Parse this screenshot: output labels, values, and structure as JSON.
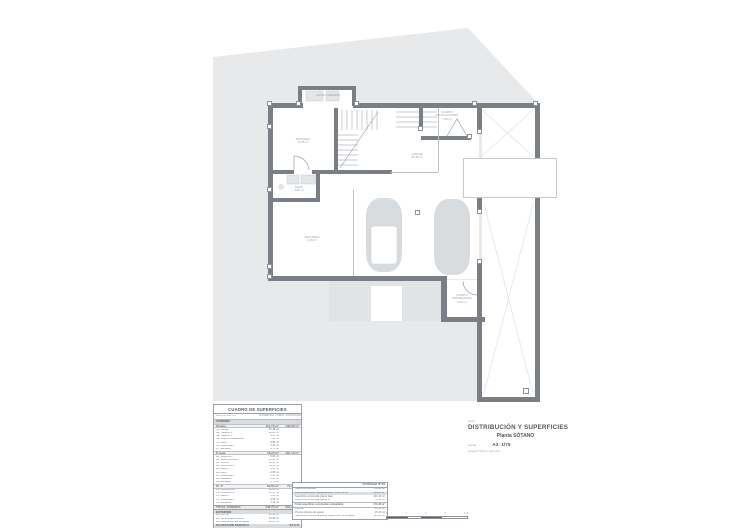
{
  "colors": {
    "site_plot": "#e7e9ea",
    "wall": "#7a7f85",
    "car": "#d9dcdf",
    "title_text": "#54585d"
  },
  "plan": {
    "rooms": {
      "grupo_presion": "GRUPO PRESIÓN",
      "trastero1": "TRASTERO\n12.05 m²",
      "bano": "BAÑO\n3.80 m²",
      "trastero2": "TRASTERO\n9.15 m²",
      "garaje": "GARAJE\n55.48 m²",
      "instalaciones": "CUARTO\nINSTALACIONES\n7.08 m²",
      "depuradora": "CUARTO\nDEPURADORA\n5.20 m²"
    }
  },
  "surfaces_table": {
    "title": "CUADRO DE SUPERFICIES",
    "headers": {
      "name": "DENOMINACIÓN",
      "util": "SUPERFICIE ÚTIL",
      "built": "SUP. CONSTRUIDA"
    },
    "rows": [
      {
        "t": "section",
        "label": "VIVIENDA",
        "util": "",
        "built": ""
      },
      {
        "t": "sub",
        "label": "Sótano",
        "util": "114.75 m²",
        "built": "130.80 m²"
      },
      {
        "t": "item",
        "label": "S1. Garaje",
        "util": "55.48 m²",
        "built": ""
      },
      {
        "t": "item",
        "label": "S2. Trastero 1",
        "util": "12.05 m²",
        "built": ""
      },
      {
        "t": "item",
        "label": "S3. Trastero 2",
        "util": "9.15 m²",
        "built": ""
      },
      {
        "t": "item",
        "label": "S4. Cuarto instalaciones",
        "util": "7.08 m²",
        "built": ""
      },
      {
        "t": "item",
        "label": "S5. Baño",
        "util": "3.80 m²",
        "built": ""
      },
      {
        "t": "item",
        "label": "S6. Distribuidor",
        "util": "4.10 m²",
        "built": ""
      },
      {
        "t": "item",
        "label": "S7. Escalera",
        "util": "4.72 m²",
        "built": ""
      },
      {
        "t": "sub",
        "label": "P. baja",
        "util": "78.20 m²",
        "built": "101.10 m²"
      },
      {
        "t": "item",
        "label": "B1. Vestíbulo",
        "util": "5.30 m²",
        "built": ""
      },
      {
        "t": "item",
        "label": "B2. Salón-comedor",
        "util": "24.60 m²",
        "built": ""
      },
      {
        "t": "item",
        "label": "B3. Cocina",
        "util": "10.15 m²",
        "built": ""
      },
      {
        "t": "item",
        "label": "B4. Dormitorio 1",
        "util": "11.20 m²",
        "built": ""
      },
      {
        "t": "item",
        "label": "B5. Baño 1",
        "util": "4.05 m²",
        "built": ""
      },
      {
        "t": "item",
        "label": "B6. Aseo",
        "util": "2.45 m²",
        "built": ""
      },
      {
        "t": "item",
        "label": "B7. Distribuidor",
        "util": "3.95 m²",
        "built": ""
      },
      {
        "t": "item",
        "label": "B8. Lavadero",
        "util": "3.60 m²",
        "built": ""
      },
      {
        "t": "item",
        "label": "B9. Escalera",
        "util": "4.72 m²",
        "built": ""
      },
      {
        "t": "sub",
        "label": "Pl. 1ª",
        "util": "55.80 m²",
        "built": "72.36 m²"
      },
      {
        "t": "item",
        "label": "P1. Dormitorio 2",
        "util": "14.20 m²",
        "built": ""
      },
      {
        "t": "item",
        "label": "P2. Dormitorio 3",
        "util": "12.35 m²",
        "built": ""
      },
      {
        "t": "item",
        "label": "P3. Baño 2",
        "util": "4.60 m²",
        "built": ""
      },
      {
        "t": "item",
        "label": "P4. Distribuidor",
        "util": "4.25 m²",
        "built": ""
      },
      {
        "t": "item",
        "label": "P5. Escalera",
        "util": "4.72 m²",
        "built": ""
      },
      {
        "t": "total",
        "label": "TOTAL VIVIENDA",
        "util": "248.75 m²",
        "built": "304.26 m²"
      },
      {
        "t": "section",
        "label": "EXTERIOR",
        "util": "",
        "built": ""
      },
      {
        "t": "item",
        "label": "E1. Porche",
        "util": "12.40 m²",
        "built": ""
      },
      {
        "t": "item",
        "label": "E2. Terraza descubierta",
        "util": "24.30 m²",
        "built": ""
      },
      {
        "t": "item",
        "label": "E3. Piscina (lámina de agua)",
        "util": "18.90 m²",
        "built": ""
      },
      {
        "t": "section",
        "label": "OCUPACIÓN PARCELA",
        "util": "",
        "built": "27.3 %"
      }
    ]
  },
  "vivienda_table": {
    "rows": [
      {
        "t": "head",
        "label": "",
        "value": "VIVIENDA Nº29"
      },
      {
        "t": "row",
        "label": "Superficie parcela",
        "value": "478.98 m²"
      },
      {
        "t": "band",
        "label": "EDIFICABILIDAD REMANENTE: 0.274 m²/m²",
        "value": "131.24 m²"
      },
      {
        "t": "row",
        "label": "Superficie construida planta baja",
        "value": "101.10 m²"
      },
      {
        "t": "row",
        "label": "Superficie construida planta 1ª",
        "value": "72.36 m²"
      },
      {
        "t": "bold",
        "label": "Total superficie construida computable",
        "value": "173.46 m²"
      },
      {
        "t": "row",
        "label": "Piscina",
        "value": "21.00 m²"
      },
      {
        "t": "row",
        "label": "Piscina (lámina de agua)",
        "value": "15.20 m²"
      },
      {
        "t": "row",
        "label": "Superficie construida planta sótano (no computable)",
        "value": "130.80 m²"
      }
    ]
  },
  "title_block": {
    "doc_label": "plano",
    "title": "DISTRIBUCIÓN Y SUPERFICIES",
    "subtitle": "Planta SÓTANO",
    "scale_label": "escala",
    "scale_value": "A3: 1/75",
    "phase": "proyecto básico y ejecución"
  },
  "scale_bar": {
    "labels": [
      {
        "label": "0"
      },
      {
        "label": "1"
      },
      {
        "label": "2"
      },
      {
        "label": "3"
      },
      {
        "label": "4 m"
      }
    ]
  }
}
